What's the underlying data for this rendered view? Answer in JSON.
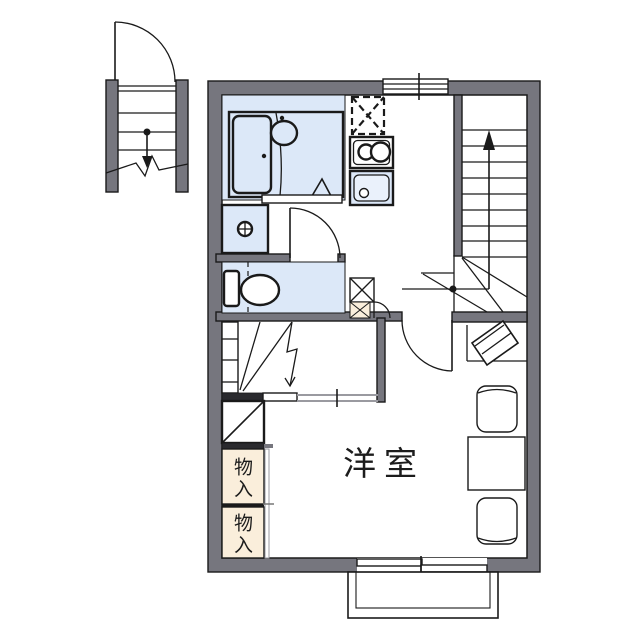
{
  "labels": {
    "main_room": "洋室",
    "storage_upper": "物入",
    "storage_lower": "物入"
  },
  "colors": {
    "wall": "#76767e",
    "wet_area": "#dce8f8",
    "storage_area": "#faeedb",
    "line": "#1a1a1a",
    "slider_gray": "#9a9aa0"
  },
  "fixtures": [
    "exterior-staircase",
    "entrance-door",
    "unit-bath",
    "bathtub",
    "washbasin",
    "shower-drain-triangle",
    "washing-machine-pan",
    "water-tap",
    "toilet",
    "refrigerator-space",
    "gas-stove-2-burner",
    "kitchen-sink",
    "kitchen-window",
    "internal-staircase-up",
    "hall-door",
    "room-door",
    "shoe-cabinet",
    "closet-shelves",
    "closet-folding-door",
    "sliding-partition",
    "storage-box",
    "storage-box",
    "tv-corner-stand",
    "table",
    "chair",
    "chair",
    "balcony",
    "balcony-sliding-door"
  ]
}
